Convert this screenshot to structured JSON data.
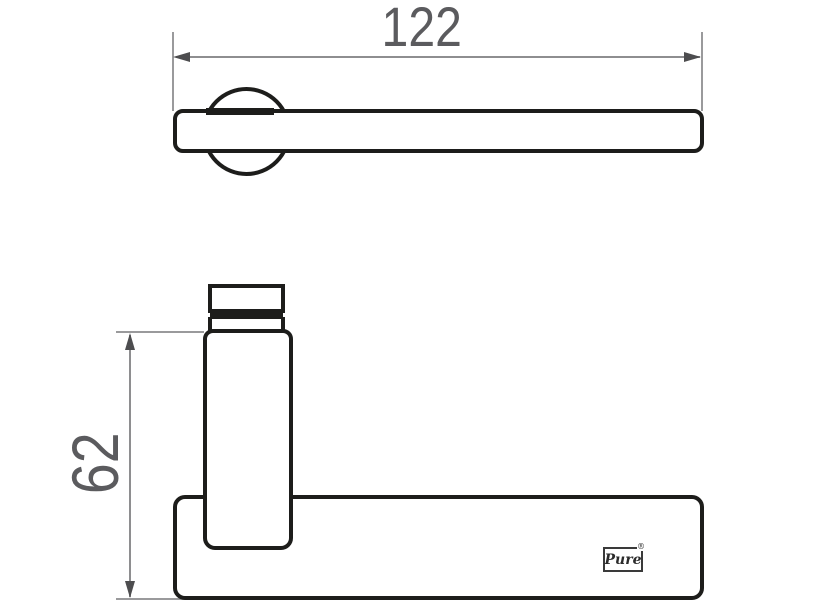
{
  "drawing": {
    "type": "technical-dimension-drawing",
    "subject": "door-lever-handle",
    "dimensions": {
      "width": {
        "value": "122"
      },
      "height": {
        "value": "62"
      }
    },
    "logo": {
      "text": "Pure",
      "registered_mark": "®"
    },
    "colors": {
      "background": "#ffffff",
      "outline": "#1d1d1b",
      "dimension_line": "#8e8e90",
      "extension_line": "#9a9a9c",
      "arrowhead": "#4d4d4f",
      "dimension_text": "#5b5b5e",
      "logo_ink": "#2b2b2b"
    }
  }
}
